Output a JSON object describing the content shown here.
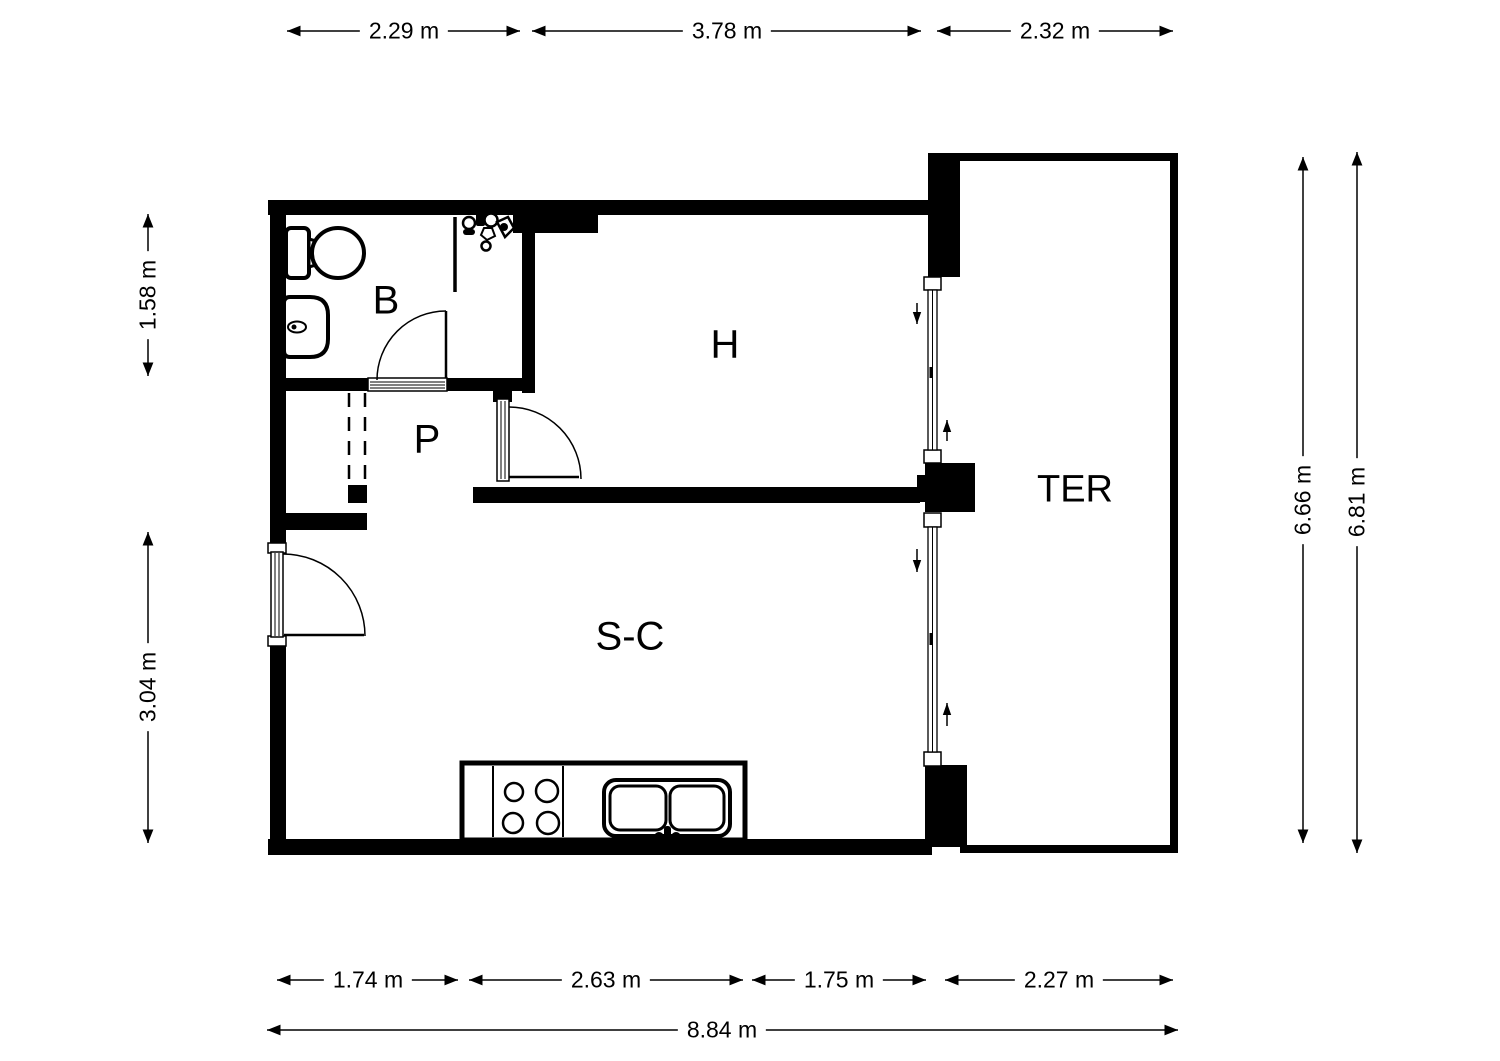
{
  "plan_title": "apartment-floor-plan",
  "colors": {
    "line": "#000000",
    "background": "#ffffff"
  },
  "rooms": {
    "bathroom": "B",
    "hall": "P",
    "bedroom": "H",
    "living_kitchen": "S-C",
    "terrace": "TER"
  },
  "dimensions": {
    "top": [
      "2.29 m",
      "3.78 m",
      "2.32 m"
    ],
    "left": [
      "1.58 m",
      "3.04 m"
    ],
    "right": [
      "6.66 m",
      "6.81 m"
    ],
    "bottom": [
      "1.74 m",
      "2.63 m",
      "1.75 m",
      "2.27 m"
    ],
    "overall": "8.84 m"
  },
  "icons": {
    "toilet": "toilet-icon",
    "sink": "sink-icon",
    "shower": "shower-icon",
    "stove": "stove-icon",
    "kitchen_sink": "kitchen-sink-icon",
    "slide_arrows": "slide-direction-arrows"
  }
}
